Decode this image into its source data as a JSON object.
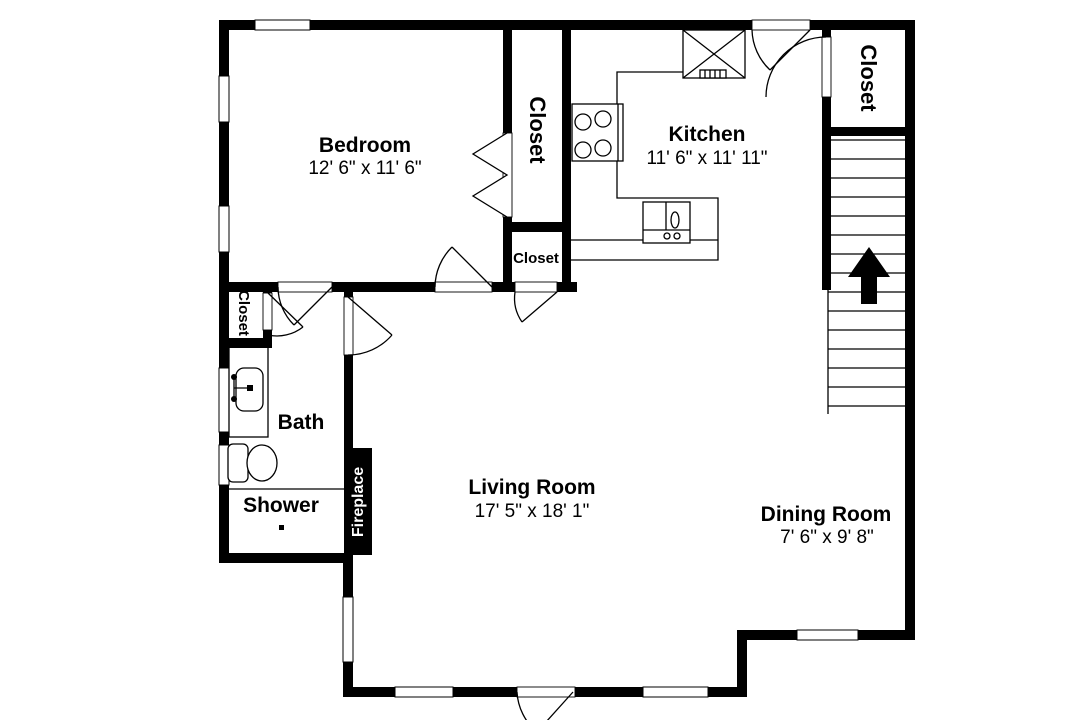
{
  "title": "Apartment floor plan",
  "colors": {
    "wall": "#000000",
    "background": "#ffffff",
    "label_text": "#000000",
    "fireplace_text": "#ffffff"
  },
  "labels": {
    "closet": "Closet"
  },
  "rooms": {
    "bedroom": {
      "name": "Bedroom",
      "dims": "12' 6\" x 11' 6\""
    },
    "kitchen": {
      "name": "Kitchen",
      "dims": "11' 6\" x 11' 11\""
    },
    "living_room": {
      "name": "Living Room",
      "dims": "17' 5\" x 18' 1\""
    },
    "dining_room": {
      "name": "Dining Room",
      "dims": "7' 6\" x 9' 8\""
    },
    "bath": {
      "name": "Bath"
    },
    "shower": {
      "name": "Shower"
    },
    "fireplace": {
      "name": "Fireplace"
    }
  },
  "symbols": {
    "stairs_up_arrow": "filled up arrow on staircase",
    "stove": "4-burner range",
    "refrigerator": "box with X and vent",
    "kitchen_sink": "double-basin sink with faucet",
    "bath_vanity": "counter with basin and faucet",
    "toilet": "tank and bowl",
    "windows": "white gaps in exterior walls",
    "doors": "quarter-circle swing arcs",
    "bifold_door": "zigzag panels at bedroom closet"
  }
}
